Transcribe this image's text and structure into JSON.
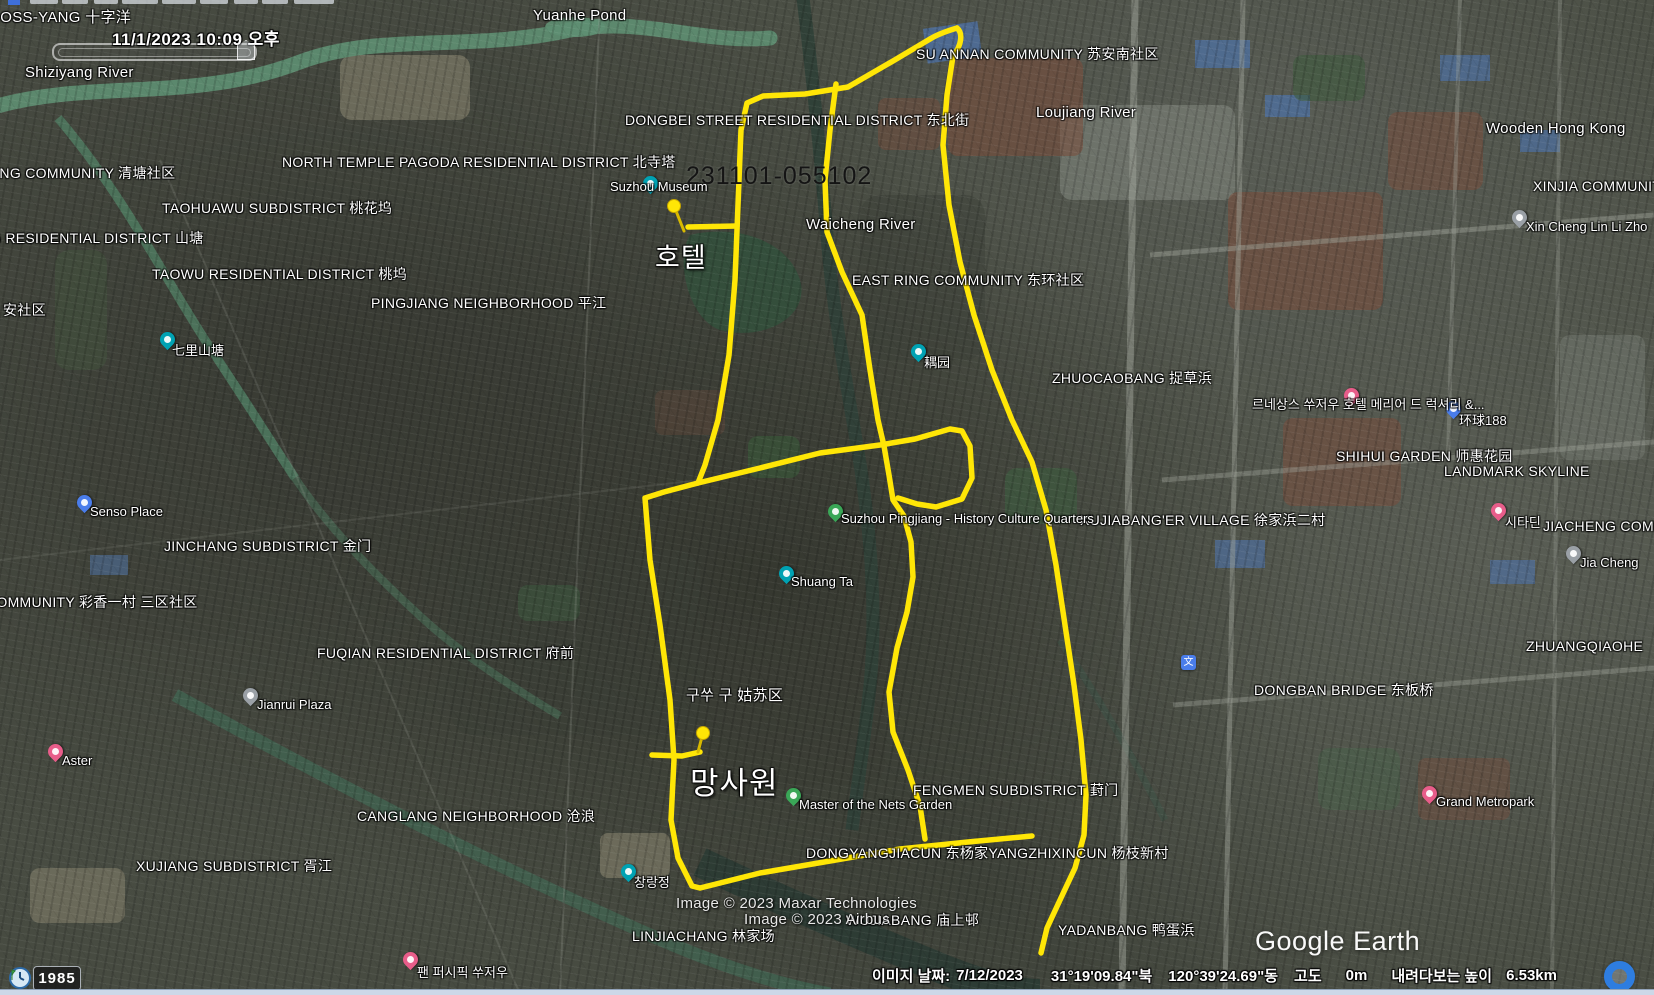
{
  "app": {
    "logo_text": "Google Earth"
  },
  "time_overlay": {
    "datetime_label": "11/1/2023  10:09 오후",
    "history_year": "1985"
  },
  "attribution": {
    "line1": "Image © 2023 Maxar Technologies",
    "line2": "Image © 2023 Airbus"
  },
  "status_bar": {
    "image_date_label": "이미지 날짜:",
    "image_date": "7/12/2023",
    "latitude": "31°19'09.84\"북",
    "longitude": "120°39'24.69\"동",
    "altitude_label": "고도",
    "altitude_value": "0m",
    "eye_altitude_label": "내려다보는 높이",
    "eye_altitude_value": "6.53km"
  },
  "track": {
    "name": "231101-055102",
    "color": "#ffe606",
    "waypoints": {
      "hotel": "호텔",
      "garden": "망사원"
    },
    "paths": {
      "main_loop": "M957,28 C947,31 938,34 930,39 L893,61 L848,87 L805,94 L763,96 L747,103 L741,130 L738,205 L735,280 L729,355 L718,420 L705,465 L698,483 L664,492 L645,498 L650,560 L660,625 L670,700 L674,760 L671,820 L678,858 L692,886 L700,888 L760,873 L830,861 L900,849 L968,842 L1032,836",
      "right_line": "M957,28 C963,33 962,45 953,56 L947,95 L943,145 L949,205 L960,262 L974,315 L992,370 L1012,420 L1032,462 L1046,510 L1056,565 L1065,625 L1074,685 L1081,740 L1086,795 L1084,835 L1075,868 L1060,900 L1047,928 L1041,953",
      "middle_line": "M836,84 L830,130 L825,180 L827,232 L842,272 L862,315 L870,370 L878,420 L884,446 L889,475 L893,500 L904,516 L911,542 L913,577 L907,612 L897,648 L889,692 L893,732 L908,770 L920,806 L925,839",
      "inner_loop": "M698,483 L760,468 L820,453 L880,445 L915,439 L950,429 L962,431 L970,446 L972,478 L962,499 L936,507 L917,504 L898,498",
      "hotel_spur": "M688,227 L737,226",
      "garden_spur": "M652,755 L682,756 L700,752"
    },
    "pushpins": [
      {
        "cx": 674,
        "cy": 206,
        "nx": 684,
        "ny": 231
      },
      {
        "cx": 703,
        "cy": 733,
        "nx": 698,
        "ny": 752
      }
    ],
    "name_pos": {
      "x": 686,
      "y": 162,
      "fs": 25
    },
    "hotel_pos": {
      "x": 655,
      "y": 236,
      "fs": 27
    },
    "garden_pos": {
      "x": 690,
      "y": 758,
      "fs": 31
    }
  },
  "map_labels": [
    {
      "t": "CROSS-YANG 十字洋",
      "x": -22,
      "y": 6,
      "fs": 15
    },
    {
      "t": "Yuanhe Pond",
      "x": 533,
      "y": 7,
      "fs": 15
    },
    {
      "t": "Shiziyang River",
      "x": 25,
      "y": 64,
      "fs": 15
    },
    {
      "t": "SU ANNAN COMMUNITY 苏安南社区",
      "x": 916,
      "y": 44
    },
    {
      "t": "Loujiang River",
      "x": 1036,
      "y": 104,
      "fs": 15
    },
    {
      "t": "DONGBEI STREET RESIDENTIAL DISTRICT 东北街",
      "x": 625,
      "y": 110
    },
    {
      "t": "Wooden Hong Kong",
      "x": 1486,
      "y": 120,
      "fs": 15
    },
    {
      "t": "NORTH TEMPLE PAGODA RESIDENTIAL DISTRICT 北寺塔",
      "x": 282,
      "y": 152
    },
    {
      "t": "QINGTANG COMMUNITY 清塘社区",
      "x": -55,
      "y": 163
    },
    {
      "t": "XINJIA COMMUNITY",
      "x": 1533,
      "y": 178
    },
    {
      "t": "TAOHUAWU SUBDISTRICT 桃花坞",
      "x": 162,
      "y": 198
    },
    {
      "t": "SHANTANG RESIDENTIAL DISTRICT 山塘",
      "x": -78,
      "y": 228
    },
    {
      "t": "Waicheng River",
      "x": 806,
      "y": 216,
      "fs": 15
    },
    {
      "t": "TAOWU RESIDENTIAL DISTRICT 桃坞",
      "x": 152,
      "y": 264
    },
    {
      "t": "EAST RING COMMUNITY 东环社区",
      "x": 852,
      "y": 270
    },
    {
      "t": "PINGJIANG NEIGHBORHOOD 平江",
      "x": 371,
      "y": 293
    },
    {
      "t": "安社区",
      "x": 3,
      "y": 300
    },
    {
      "t": "ZHUOCAOBANG 捉草浜",
      "x": 1052,
      "y": 368
    },
    {
      "t": "SHIHUI GARDEN 师惠花园",
      "x": 1336,
      "y": 446
    },
    {
      "t": "LANDMARK SKYLINE",
      "x": 1444,
      "y": 463
    },
    {
      "t": "XUJIABANG'ER VILLAGE 徐家浜二村",
      "x": 1080,
      "y": 510
    },
    {
      "t": "JIACHENG COMMUNITY",
      "x": 1543,
      "y": 518
    },
    {
      "t": "JINCHANG SUBDISTRICT 金门",
      "x": 164,
      "y": 536
    },
    {
      "t": "COMMUNITY 彩香一村 三区社区",
      "x": -14,
      "y": 592
    },
    {
      "t": "ZHUANGQIAOHE",
      "x": 1526,
      "y": 638
    },
    {
      "t": "FUQIAN RESIDENTIAL DISTRICT 府前",
      "x": 317,
      "y": 643
    },
    {
      "t": "DONGBAN BRIDGE 东板桥",
      "x": 1254,
      "y": 680
    },
    {
      "t": "구쑤 구 姑苏区",
      "x": 686,
      "y": 684,
      "fs": 15
    },
    {
      "t": "FENGMEN SUBDISTRICT 葑门",
      "x": 913,
      "y": 780
    },
    {
      "t": "CANGLANG NEIGHBORHOOD 沧浪",
      "x": 357,
      "y": 806
    },
    {
      "t": "DONGYANGJIACUN 东杨家YANGZHIXINCUN 杨枝新村",
      "x": 806,
      "y": 843
    },
    {
      "t": "XUJIANG SUBDISTRICT 胥江",
      "x": 136,
      "y": 856
    },
    {
      "t": "WUJIABANG 庙上邨",
      "x": 846,
      "y": 910
    },
    {
      "t": "LINJIACHANG 林家场",
      "x": 632,
      "y": 926
    },
    {
      "t": "YADANBANG 鸭蛋浜",
      "x": 1058,
      "y": 920
    }
  ],
  "pins": [
    {
      "type": "photo",
      "x": 643,
      "y": 176,
      "label": "Suzhou Museum",
      "lx": 610,
      "ly": 179
    },
    {
      "type": "photo",
      "x": 160,
      "y": 332,
      "label": "七里山塘",
      "lx": 172,
      "ly": 340
    },
    {
      "type": "photo",
      "x": 911,
      "y": 344,
      "label": "耦园",
      "lx": 924,
      "ly": 352
    },
    {
      "type": "photo",
      "x": 779,
      "y": 566,
      "label": "Shuang Ta",
      "lx": 791,
      "ly": 574
    },
    {
      "type": "photo",
      "x": 621,
      "y": 864,
      "label": "창랑정",
      "lx": 634,
      "ly": 872
    },
    {
      "type": "tree",
      "x": 828,
      "y": 504,
      "label": "Suzhou Pingjiang - History Culture Quarters",
      "lx": 841,
      "ly": 511
    },
    {
      "type": "tree",
      "x": 786,
      "y": 788,
      "label": "Master of the Nets Garden",
      "lx": 799,
      "ly": 797
    },
    {
      "type": "shop",
      "x": 77,
      "y": 495,
      "label": "Senso Place",
      "lx": 90,
      "ly": 504
    },
    {
      "type": "shop",
      "x": 1446,
      "y": 401,
      "label": "环球188",
      "lx": 1459,
      "ly": 410
    },
    {
      "type": "hotel",
      "x": 48,
      "y": 744,
      "label": "Aster",
      "lx": 62,
      "ly": 753
    },
    {
      "type": "hotel",
      "x": 1344,
      "y": 388,
      "label": "르네상스 쑤저우 호텔 메리어 드 럭셔리 &...",
      "lx": 1252,
      "ly": 394
    },
    {
      "type": "hotel",
      "x": 403,
      "y": 952,
      "label": "팬 퍼시픽 쑤저우",
      "lx": 417,
      "ly": 962
    },
    {
      "type": "hotel",
      "x": 1491,
      "y": 503,
      "label": "시타딘",
      "lx": 1505,
      "ly": 512
    },
    {
      "type": "hotel",
      "x": 1422,
      "y": 786,
      "label": "Grand Metropark",
      "lx": 1436,
      "ly": 794
    },
    {
      "type": "generic",
      "x": 243,
      "y": 688,
      "label": "Jianrui Plaza",
      "lx": 257,
      "ly": 697
    },
    {
      "type": "generic",
      "x": 1512,
      "y": 210,
      "label": "Xin Cheng Lin Li Zho",
      "lx": 1526,
      "ly": 219
    },
    {
      "type": "generic",
      "x": 1566,
      "y": 546,
      "label": "Jia Cheng",
      "lx": 1580,
      "ly": 555
    },
    {
      "type": "culture",
      "x": 1181,
      "y": 655,
      "label": "",
      "glyph": "文",
      "lx": 0,
      "ly": 0
    }
  ],
  "pin_colors": {
    "photo": "#00a2b3",
    "tree": "#3aa757",
    "shop": "#4a7deb",
    "hotel": "#e85d8a",
    "generic": "#9aa0a6",
    "culture": "#4a7deb"
  }
}
